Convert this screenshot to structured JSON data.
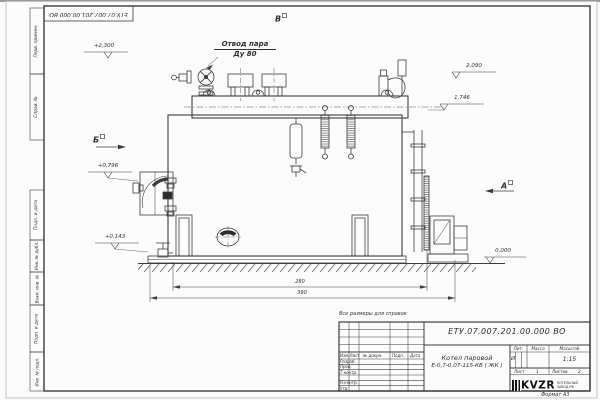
{
  "frame": {
    "top_stamp_code": "ЕТУ.07.007.201.00.000  ВО",
    "format_label": "Формат А3",
    "margin_fields": [
      {
        "label": "Перв. примен."
      },
      {
        "label": "Справ. №"
      },
      {
        "label": "Подп. и дата"
      },
      {
        "label": "Инв. № дубл."
      },
      {
        "label": "Взам. инв. №"
      },
      {
        "label": "Подп. и дата"
      },
      {
        "label": "Инв. № подл."
      }
    ]
  },
  "drawing": {
    "callout": {
      "line1": "Отвод пара",
      "line2": "Ду 80"
    },
    "views": {
      "top": "В",
      "left": "Б",
      "right": "А"
    },
    "elevations": {
      "valve_top": "+2,300",
      "hatch_top": "2,090",
      "drum_axis": "1,746",
      "door_axis": "+0,796",
      "base": "+0,143",
      "ground": "0,000"
    },
    "dimensions": {
      "boiler_length": "280",
      "overall_length": "390"
    }
  },
  "title_block": {
    "note": "Все размеры для справок",
    "doc_code": "ЕТУ.07.007.201.00.000  ВО",
    "product_line1": "Котел паровой",
    "product_line2": "Е-0,7-0,07-115-КБ ( ЖК )",
    "cols": {
      "c1": "Изм.",
      "c2": "Лист",
      "c3": "№ докум.",
      "c4": "Подп.",
      "c5": "Дата"
    },
    "rows": {
      "r1": "Разраб.",
      "r2": "Пров.",
      "r3": "Т.контр.",
      "r4": "Н.контр.",
      "r5": "Утв."
    },
    "stamp": {
      "lit_label": "Лит.",
      "lit_value": "И",
      "mass_label": "Масса",
      "scale_label": "Масштаб",
      "scale_value": "1:15",
      "sheet_label": "Лист",
      "sheet_value": "1",
      "sheets_label": "Листов",
      "sheets_value": "2"
    },
    "logo": {
      "text": "KVZR",
      "sub1": "КОТЕЛЬНЫЙ",
      "sub2": "ЗАВОД РФ"
    }
  }
}
